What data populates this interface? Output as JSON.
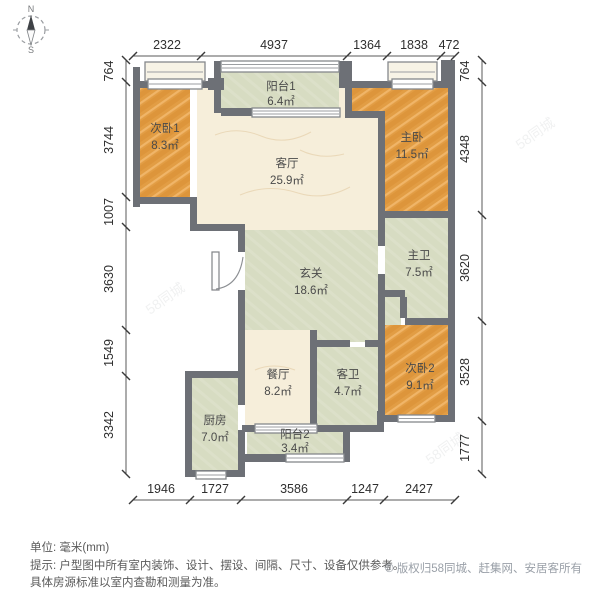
{
  "compass": {
    "north": "N",
    "south": "S"
  },
  "rooms": {
    "balcony1": {
      "name": "阳台1",
      "area": "6.4㎡"
    },
    "bedroom1": {
      "name": "次卧1",
      "area": "8.3㎡"
    },
    "master_bedroom": {
      "name": "主卧",
      "area": "11.5㎡"
    },
    "living_room": {
      "name": "客厅",
      "area": "25.9㎡"
    },
    "hallway": {
      "name": "玄关",
      "area": "18.6㎡"
    },
    "master_bath": {
      "name": "主卫",
      "area": "7.5㎡"
    },
    "dining_room": {
      "name": "餐厅",
      "area": "8.2㎡"
    },
    "guest_bath": {
      "name": "客卫",
      "area": "4.7㎡"
    },
    "bedroom2": {
      "name": "次卧2",
      "area": "9.1㎡"
    },
    "kitchen": {
      "name": "厨房",
      "area": "7.0㎡"
    },
    "balcony2": {
      "name": "阳台2",
      "area": "3.4㎡"
    }
  },
  "dims": {
    "top": [
      "2322",
      "4937",
      "1364",
      "1838",
      "472"
    ],
    "left": [
      "764",
      "3744",
      "1007",
      "3630",
      "1549",
      "3342"
    ],
    "right": [
      "764",
      "4348",
      "3620",
      "3528",
      "1777"
    ],
    "bottom": [
      "1946",
      "1727",
      "3586",
      "1247",
      "2427"
    ]
  },
  "footer": {
    "unit": "单位: 毫米(mm)",
    "tip1": "提示: 户型图中所有室内装饰、设计、摆设、间隔、尺寸、设备仅供参考。",
    "tip2": "具体房源标准以室内查勘和测量为准。",
    "copyright": "© 版权归58同城、赶集网、安居客所有"
  },
  "watermark": "58同城",
  "colors": {
    "wall": "#6d7076",
    "wood": "#e29d44",
    "cream": "#f6eeda",
    "green": "#d7dcc2"
  }
}
